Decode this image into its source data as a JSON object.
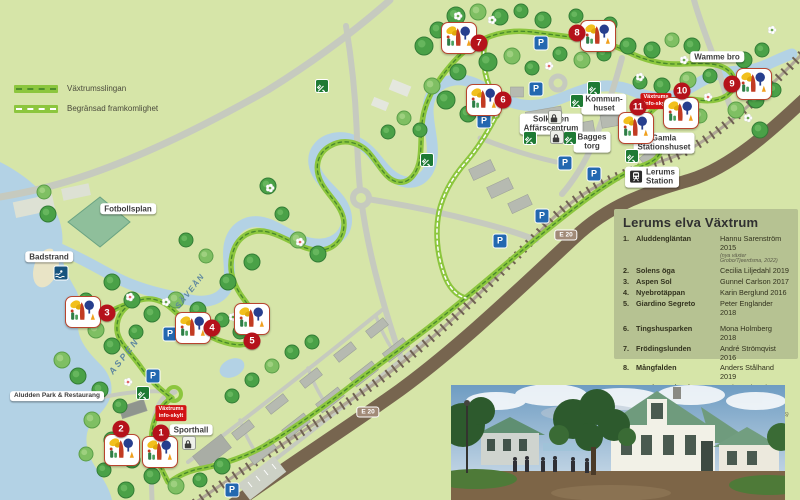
{
  "map_key": {
    "trail": "Växtrumsslingan",
    "limited": "Begränsad framkomlighet"
  },
  "legend": {
    "title": "Lerums elva Växtrum",
    "items": [
      {
        "num": "1.",
        "name": "Aluddengläntan",
        "artist": "Hannu Sarenström 2015",
        "note": "(nya växter Grobo/Tjeerdsma, 2022)"
      },
      {
        "num": "2.",
        "name": "Solens öga",
        "artist": "Cecilia Liljedahl 2019"
      },
      {
        "num": "3.",
        "name": "Aspen Sol",
        "artist": "Gunnel Carlson 2017"
      },
      {
        "num": "4.",
        "name": "Nyebrotäppan",
        "artist": "Karin Berglund 2016"
      },
      {
        "num": "5.",
        "name": "Giardino Segreto",
        "artist": "Peter Englander 2018",
        "gap": true
      },
      {
        "num": "6.",
        "name": "Tingshusparken",
        "artist": "Mona Holmberg 2018"
      },
      {
        "num": "7.",
        "name": "Frödingslunden",
        "artist": "André Strömqvist 2016"
      },
      {
        "num": "8.",
        "name": "Mångfalden",
        "artist": "Anders Stålhand 2019"
      },
      {
        "num": "9.",
        "name": "Snödroppslunden",
        "artist": "Gerben Tjeerdsma 2017"
      },
      {
        "num": "10.",
        "name": "Brobackenslänten",
        "name2": "/Tillväxten",
        "artist": "Eva Robild 2021",
        "note": "(tidigare Simon Irvine) (2015)"
      },
      {
        "num": "11.",
        "name": "Kraftfältet",
        "artist": "Peter Korn 2023"
      }
    ]
  },
  "labels": {
    "fotbollsplan": "Fotbollsplan",
    "badstrand": "Badstrand",
    "wamme_bro": "Wamme bro",
    "kommunhuset_1": "Kommun-",
    "kommunhuset_2": "huset",
    "solkatten_1": "Solkatten",
    "solkatten_2": "Affärscentrum",
    "bagges_1": "Bagges",
    "bagges_2": "torg",
    "gamla_1": "Gamla",
    "gamla_2": "Stationshuset",
    "station_1": "Lerums",
    "station_2": "Station",
    "sporthall": "Sporthall",
    "aludden": "Aludden Park & Restaurang",
    "aspen": "ASPEN",
    "savean": "SÄVEÅN",
    "e20": "E 20",
    "infosign_1": "Växtrums",
    "infosign_2": "info-skylt"
  },
  "markers": [
    {
      "number": "1",
      "name": "Aluddengläntan"
    },
    {
      "number": "2",
      "name": "Solens öga"
    },
    {
      "number": "3",
      "name": "Aspen Sol"
    },
    {
      "number": "4",
      "name": "Nyebrotäppan"
    },
    {
      "number": "5",
      "name": "Giardino Segreto"
    },
    {
      "number": "6",
      "name": "Tingshusparken"
    },
    {
      "number": "7",
      "name": "Frödingslunden"
    },
    {
      "number": "8",
      "name": "Mångfalden"
    },
    {
      "number": "9",
      "name": "Snödroppslunden"
    },
    {
      "number": "10",
      "name": "Brobackenslänten / Tillväxten"
    },
    {
      "number": "11",
      "name": "Kraftfältet"
    }
  ],
  "icons": {
    "parking": "P",
    "restaurant": "fork-and-knife-icon",
    "shop": "bag-icon",
    "swimming": "swimmer-icon",
    "train": "train-icon",
    "flower": "flower-icon",
    "vaxtrum_logo": "vaxtrum-garden-logo"
  },
  "colors": {
    "land": "#d6e5a8",
    "water": "#b3d2e5",
    "trail": "#8cc63e",
    "trail_dash": "#4e8f2a",
    "road": "#c6cabf",
    "highway": "#77654f",
    "marker_red": "#b5121b",
    "legend_bg": "#b6c292",
    "info_sign_red": "#d11414",
    "parking_blue": "#2368b0"
  }
}
